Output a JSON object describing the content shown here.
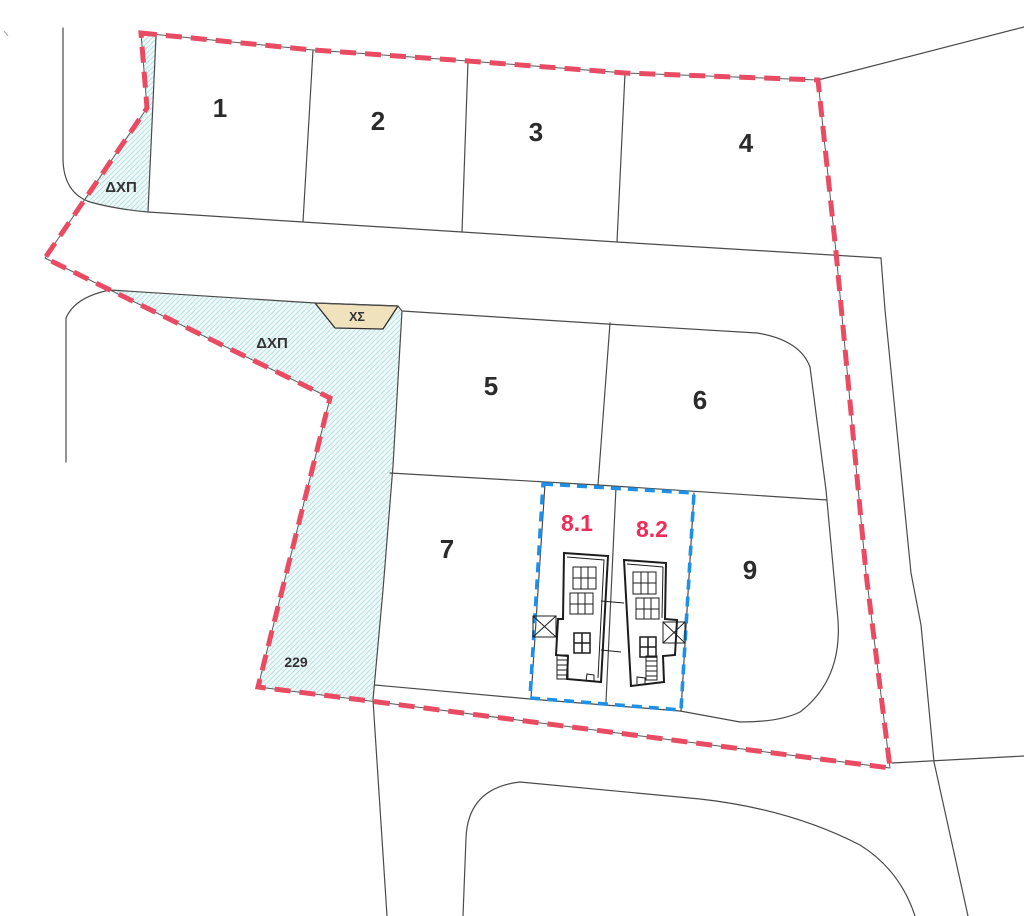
{
  "plan": {
    "plots": [
      {
        "label": "1"
      },
      {
        "label": "2"
      },
      {
        "label": "3"
      },
      {
        "label": "4"
      },
      {
        "label": "5"
      },
      {
        "label": "6"
      },
      {
        "label": "7"
      },
      {
        "label": "9"
      }
    ],
    "units": [
      {
        "label": "8.1"
      },
      {
        "label": "8.2"
      }
    ],
    "open_space_labels": [
      {
        "label": "ΔΧΠ"
      },
      {
        "label": "ΔΧΠ"
      }
    ],
    "parking_label": {
      "label": "ΧΣ"
    },
    "parcel_number": {
      "label": "229"
    },
    "colors": {
      "boundary": "#e94b63",
      "unit_outline": "#1e90e8",
      "unit_label": "#ee2c59",
      "plot_label": "#2b2b2b",
      "hatch_fill": "#f0f9f9",
      "hatch_line": "#b9e2e3",
      "xs_fill": "#f0e2bd",
      "line": "#4a4a4a"
    }
  }
}
